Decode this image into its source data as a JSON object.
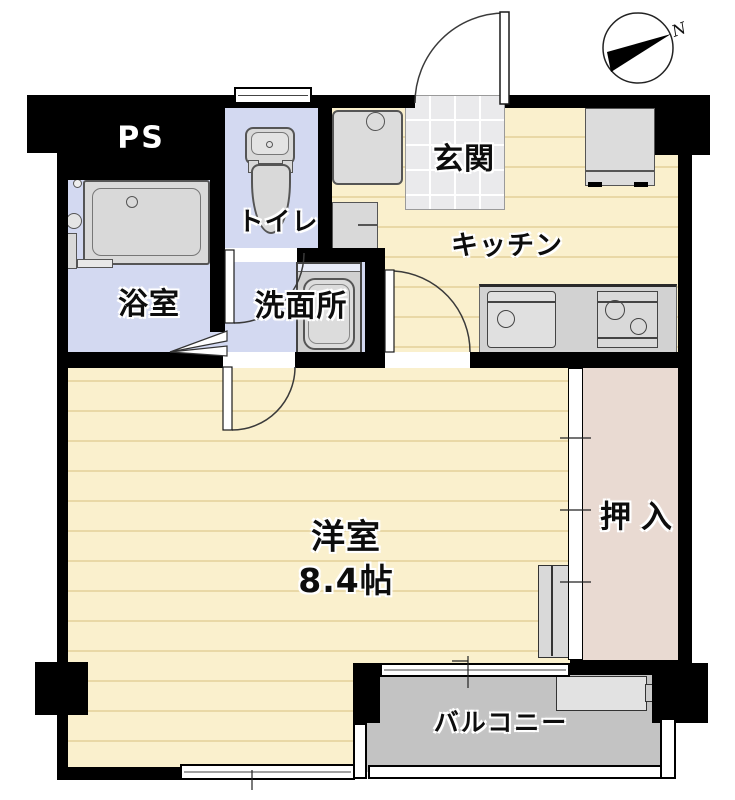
{
  "plan_title": "apartment-floor-plan",
  "rooms": {
    "ps": "PS",
    "toilet": "トイレ",
    "entrance": "玄関",
    "kitchen": "キッチン",
    "bath": "浴室",
    "washroom": "洗面所",
    "western_room": "洋室",
    "western_room_size": "8.4帖",
    "closet": "押入",
    "balcony": "バルコニー"
  },
  "compass": {
    "north_label": "N"
  },
  "colors": {
    "wall": "#000000",
    "water_room_floor": "#d3d9f1",
    "wood_floor": "#faf0cd",
    "wood_floor_line": "#e9d8a6",
    "closet_floor": "#e9dad2",
    "balcony_floor": "#c3c3c3",
    "entrance_tile": "#eaeaec",
    "fixture_gray": "#d9d9d9"
  }
}
